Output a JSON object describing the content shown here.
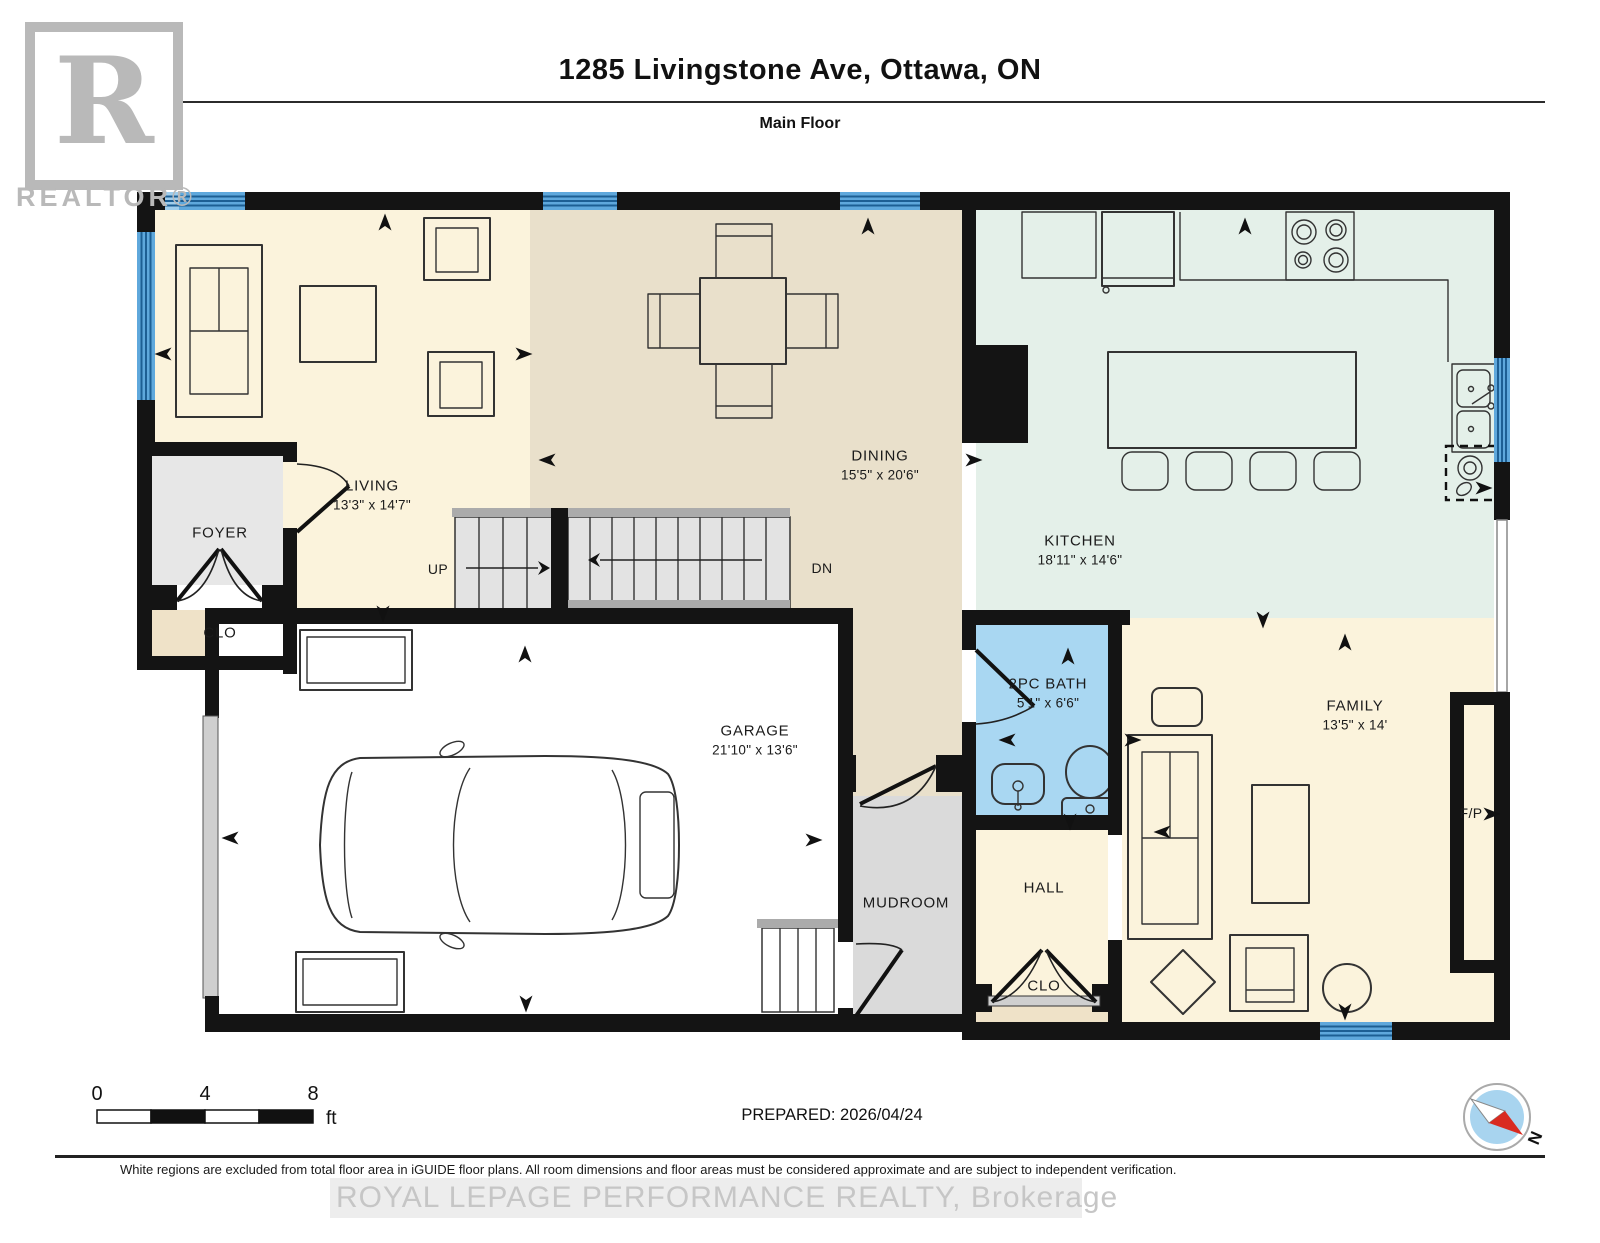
{
  "header": {
    "title": "1285 Livingstone Ave, Ottawa, ON",
    "subtitle": "Main Floor"
  },
  "branding": {
    "realtor_letter": "R",
    "realtor_word": "REALTOR®",
    "watermark": "ROYAL LEPAGE PERFORMANCE REALTY, Brokerage"
  },
  "rooms": [
    {
      "id": "living",
      "name": "LIVING",
      "dims": "13'3\" x 14'7\""
    },
    {
      "id": "dining",
      "name": "DINING",
      "dims": "15'5\" x 20'6\""
    },
    {
      "id": "kitchen",
      "name": "KITCHEN",
      "dims": "18'11\" x 14'6\""
    },
    {
      "id": "family",
      "name": "FAMILY",
      "dims": "13'5\" x 14'"
    },
    {
      "id": "garage",
      "name": "GARAGE",
      "dims": "21'10\" x 13'6\""
    },
    {
      "id": "bath",
      "name": "2PC BATH",
      "dims": "5'1\" x 6'6\""
    },
    {
      "id": "foyer",
      "name": "FOYER"
    },
    {
      "id": "foyer_closet",
      "name": "CLO"
    },
    {
      "id": "mudroom",
      "name": "MUDROOM"
    },
    {
      "id": "hall",
      "name": "HALL"
    },
    {
      "id": "hall_closet",
      "name": "CLO"
    },
    {
      "id": "fireplace",
      "name": "F/P"
    }
  ],
  "stairs": {
    "up": "UP",
    "down": "DN"
  },
  "scale_bar": {
    "tick0": "0",
    "tick1": "4",
    "tick2": "8",
    "unit": "ft"
  },
  "prepared": "PREPARED: 2026/04/24",
  "compass": {
    "north": "N"
  },
  "footer": {
    "disclaimer": "White regions are excluded from total floor area in iGUIDE floor plans. All room dimensions and floor areas must be considered approximate and are subject to independent verification."
  },
  "colors": {
    "wall": "#141414",
    "cream": "#FBF3DC",
    "tan": "#E9E0CB",
    "mint": "#E4F0E9",
    "bathblue": "#A9D7F2",
    "graymud": "#DADADA",
    "grayfoyer": "#E7E7E7",
    "clotan": "#EFE2C8",
    "windowblue": "#5FA8DC",
    "windowlight": "#9FCDEC",
    "windowline": "#1D5F94",
    "watermark": "#C6C6C6",
    "compassblue": "#A8D4EF",
    "compassred": "#D92B21",
    "doorgray": "#CFCFCF"
  }
}
